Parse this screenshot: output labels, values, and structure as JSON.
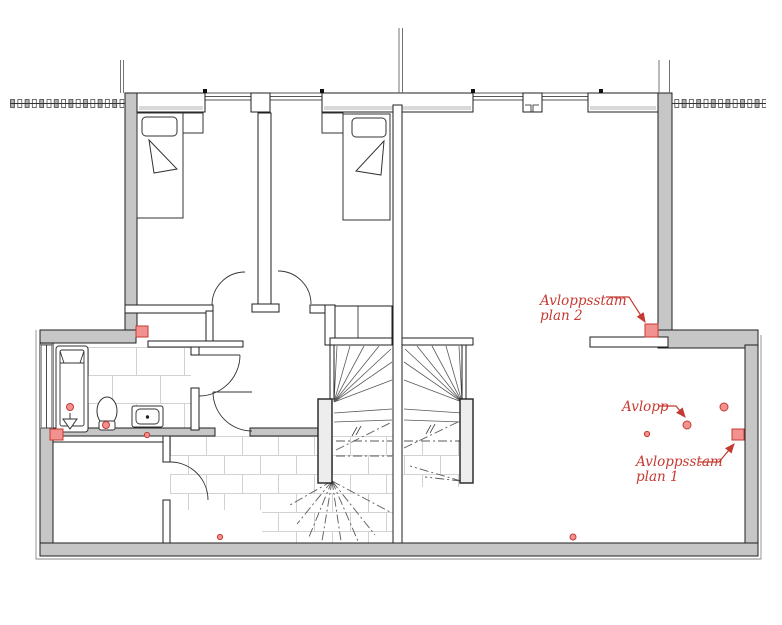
{
  "annotations": {
    "plan2": {
      "line1": "Avloppsstam",
      "line2": "plan 2"
    },
    "avlopp": {
      "label": "Avlopp"
    },
    "plan1": {
      "line1": "Avloppsstam",
      "line2": "plan 1"
    }
  },
  "markers": {
    "sewer_stack_icon": "red-square",
    "drain_icon": "red-dot"
  },
  "colors": {
    "wall_gray": "#c6c6c6",
    "line_dark": "#1f1f1f",
    "fixture_line": "#333333",
    "stair_line": "#5a5a5a",
    "tile_line": "#d2d2d2",
    "annotation_red": "#c53a32",
    "marker_fill": "#f29290"
  }
}
